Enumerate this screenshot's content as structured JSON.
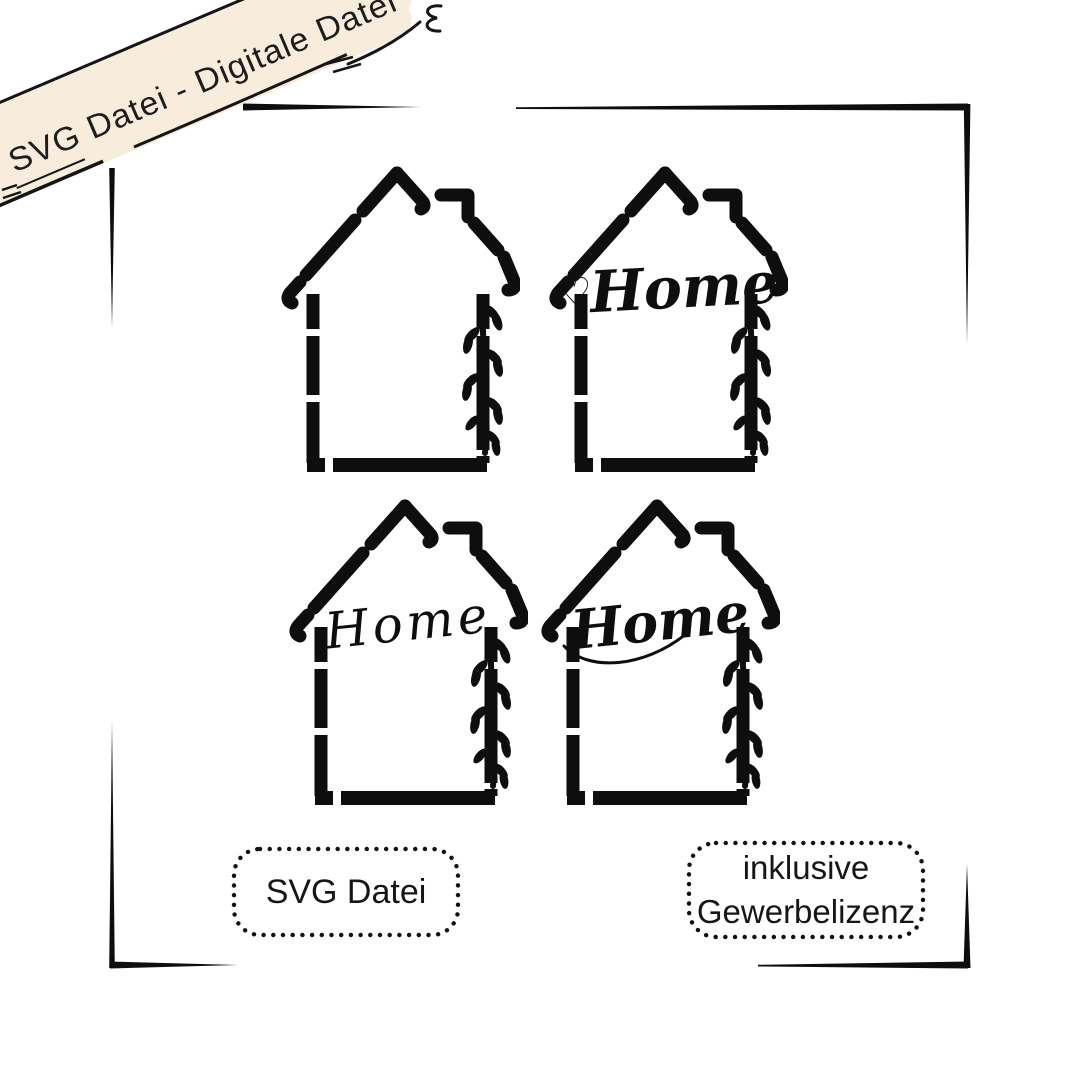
{
  "banner": {
    "text": "SVG Datei - Digitale Datei"
  },
  "houses": [
    {
      "name": "house-frame-plain",
      "text": ""
    },
    {
      "name": "house-frame-home-heart",
      "heart": "♡",
      "text": "Home"
    },
    {
      "name": "house-frame-home-thin-script",
      "text": "Home"
    },
    {
      "name": "house-frame-home-swash-script",
      "text": "Home"
    }
  ],
  "badges": {
    "left": {
      "label": "SVG Datei"
    },
    "right": {
      "line1": "inklusive",
      "line2": "Gewerbelizenz"
    }
  },
  "colors": {
    "ink": "#0e0e0e",
    "banner_fill": "#f8ecdc",
    "background": "#ffffff",
    "text": "#1a1a1a"
  }
}
